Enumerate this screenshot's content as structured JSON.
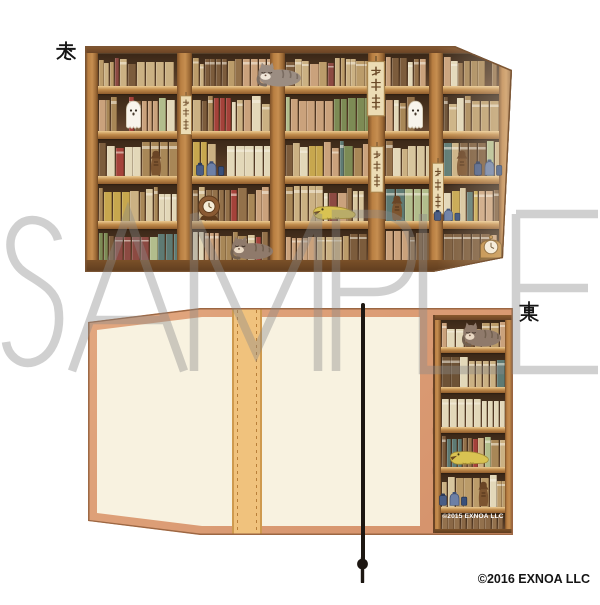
{
  "product": {
    "front_label": "表",
    "back_label": "裏",
    "watermark": "SAMPLE",
    "copyright": "©2016 EXNOA LLC",
    "artwork_copyright": "©2015 EXNOA LLC"
  },
  "colors": {
    "page_bg": "#ffffff",
    "watermark_stroke": "#8a8a8a",
    "wood": "#b5793f",
    "wood_dark": "#6b4426",
    "shelf_interior": "#3a2717",
    "trim": "#dc9d77",
    "inner_cream": "#f8f2e0",
    "spine_strip": "#f0c27d",
    "string": "#1d1712",
    "label_color": "#161616"
  },
  "book_palette": [
    "#d8c69e",
    "#cbb183",
    "#bb9c6a",
    "#a88757",
    "#93714a",
    "#7c5c3c",
    "#e3d8b9",
    "#caa27c",
    "#a4423a",
    "#8c4a42",
    "#7d8b55",
    "#b2bd8c",
    "#5e7a73",
    "#c7a74e",
    "#6d5236"
  ],
  "artwork": {
    "front_shelf": {
      "w": 427,
      "h": 226,
      "cornice": {
        "y": 0,
        "h": 7
      },
      "base": {
        "y": 214,
        "h": 12
      },
      "pillars": [
        [
          0,
          13
        ],
        [
          92,
          15
        ],
        [
          185,
          15
        ],
        [
          283,
          17
        ],
        [
          344,
          14
        ],
        [
          414,
          13
        ]
      ],
      "boards": [
        [
          40,
          8
        ],
        [
          85,
          8
        ],
        [
          130,
          8
        ],
        [
          175,
          8
        ]
      ],
      "rows": [
        [
          8,
          40
        ],
        [
          48,
          85
        ],
        [
          93,
          130
        ],
        [
          138,
          175
        ],
        [
          183,
          214
        ]
      ],
      "uniform_last_row": false
    },
    "front_sprites": [
      {
        "type": "cat-gray",
        "x": 166,
        "y": 15,
        "w": 52,
        "h": 26
      },
      {
        "type": "tag",
        "x": 280,
        "y": 10,
        "w": 22,
        "h": 62
      },
      {
        "type": "tag",
        "x": 94,
        "y": 46,
        "w": 14,
        "h": 44
      },
      {
        "type": "ghost",
        "x": 40,
        "y": 54,
        "w": 17,
        "h": 31
      },
      {
        "type": "ghost",
        "x": 322,
        "y": 54,
        "w": 17,
        "h": 31
      },
      {
        "type": "tag",
        "x": 284,
        "y": 96,
        "w": 16,
        "h": 52
      },
      {
        "type": "figurine",
        "x": 64,
        "y": 104,
        "w": 14,
        "h": 26
      },
      {
        "type": "figurine",
        "x": 370,
        "y": 104,
        "w": 14,
        "h": 26
      },
      {
        "type": "jars",
        "x": 110,
        "y": 112,
        "w": 30,
        "h": 18
      },
      {
        "type": "jars",
        "x": 388,
        "y": 110,
        "w": 30,
        "h": 20
      },
      {
        "type": "tag",
        "x": 346,
        "y": 112,
        "w": 14,
        "h": 58
      },
      {
        "type": "clock-brown",
        "x": 110,
        "y": 148,
        "w": 28,
        "h": 27
      },
      {
        "type": "figurine",
        "x": 305,
        "y": 149,
        "w": 14,
        "h": 26
      },
      {
        "type": "tsuchinoko",
        "x": 226,
        "y": 158,
        "w": 46,
        "h": 17
      },
      {
        "type": "jars",
        "x": 348,
        "y": 160,
        "w": 28,
        "h": 15
      },
      {
        "type": "cat-brown",
        "x": 140,
        "y": 189,
        "w": 50,
        "h": 25
      },
      {
        "type": "clock-gold",
        "x": 392,
        "y": 187,
        "w": 28,
        "h": 27
      }
    ],
    "back_flap_shelf": {
      "w": 80,
      "h": 218,
      "cornice": {
        "y": 0,
        "h": 5
      },
      "base": {
        "y": 214,
        "h": 4
      },
      "pillars": [
        [
          0,
          8
        ],
        [
          72,
          8
        ]
      ],
      "boards": [
        [
          32,
          6
        ],
        [
          72,
          6
        ],
        [
          112,
          6
        ],
        [
          152,
          6
        ],
        [
          192,
          6
        ]
      ],
      "rows": [
        [
          5,
          32
        ],
        [
          38,
          72
        ],
        [
          78,
          112
        ],
        [
          118,
          152
        ],
        [
          158,
          192
        ],
        [
          198,
          214
        ]
      ],
      "uniform_last_row": true
    },
    "back_flap_sprites": [
      {
        "type": "cat-brown",
        "x": 24,
        "y": 6,
        "w": 46,
        "h": 26
      },
      {
        "type": "tsuchinoko",
        "x": 15,
        "y": 134,
        "w": 42,
        "h": 17
      },
      {
        "type": "figurine",
        "x": 44,
        "y": 166,
        "w": 13,
        "h": 26
      },
      {
        "type": "jars",
        "x": 5,
        "y": 174,
        "w": 30,
        "h": 17
      }
    ]
  }
}
